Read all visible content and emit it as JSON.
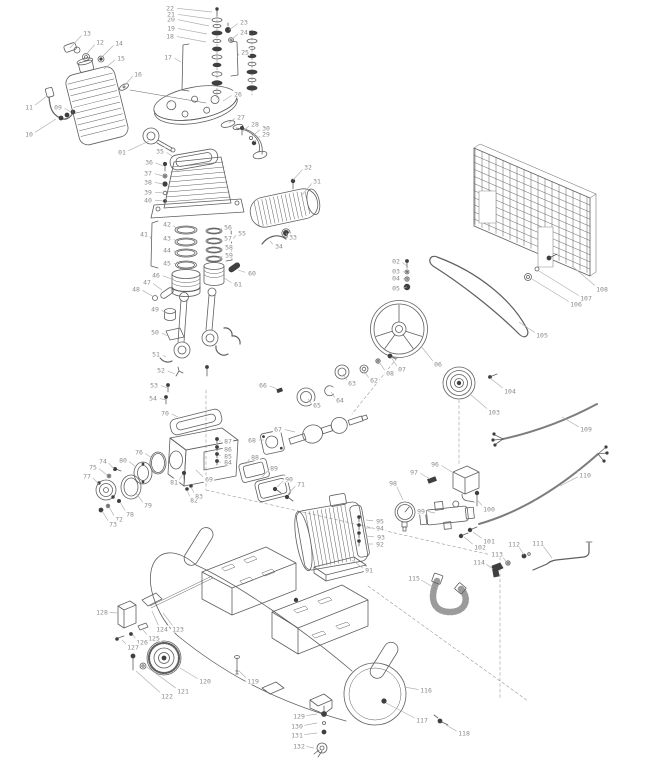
{
  "meta": {
    "canvas": {
      "width": 646,
      "height": 768
    }
  },
  "style": {
    "background": "#ffffff",
    "line_color": "#5f5f5f",
    "dark_hardware_color": "#3f3f3f",
    "label_color": "#8a8a8a",
    "leader_color": "#aeaeae"
  },
  "callouts": [
    {
      "n": "01",
      "x": 122,
      "y": 152,
      "tx": 149,
      "ty": 141
    },
    {
      "n": "02",
      "x": 396,
      "y": 261,
      "tx": 407,
      "ty": 266
    },
    {
      "n": "03",
      "x": 396,
      "y": 271,
      "tx": 407,
      "ty": 273
    },
    {
      "n": "04",
      "x": 396,
      "y": 278,
      "tx": 407,
      "ty": 280
    },
    {
      "n": "05",
      "x": 396,
      "y": 288,
      "tx": 407,
      "ty": 287
    },
    {
      "n": "06",
      "x": 438,
      "y": 364,
      "tx": 421,
      "ty": 346
    },
    {
      "n": "07",
      "x": 402,
      "y": 369,
      "tx": 391,
      "ty": 357
    },
    {
      "n": "08",
      "x": 390,
      "y": 373,
      "tx": 379,
      "ty": 362
    },
    {
      "n": "09",
      "x": 58,
      "y": 107,
      "tx": 71,
      "ty": 112
    },
    {
      "n": "10",
      "x": 29,
      "y": 134,
      "tx": 56,
      "ty": 119
    },
    {
      "n": "11",
      "x": 29,
      "y": 107,
      "tx": 47,
      "ty": 96
    },
    {
      "n": "12",
      "x": 100,
      "y": 42,
      "tx": 85,
      "ty": 56
    },
    {
      "n": "13",
      "x": 87,
      "y": 33,
      "tx": 70,
      "ty": 48
    },
    {
      "n": "14",
      "x": 119,
      "y": 43,
      "tx": 101,
      "ty": 58
    },
    {
      "n": "15",
      "x": 121,
      "y": 58,
      "tx": 104,
      "ty": 69
    },
    {
      "n": "16",
      "x": 138,
      "y": 74,
      "tx": 124,
      "ty": 86
    },
    {
      "n": "17",
      "x": 168,
      "y": 57,
      "tx": 181,
      "ty": 62
    },
    {
      "n": "18",
      "x": 170,
      "y": 36,
      "tx": 206,
      "ty": 42
    },
    {
      "n": "19",
      "x": 171,
      "y": 28,
      "tx": 207,
      "ty": 34
    },
    {
      "n": "20",
      "x": 171,
      "y": 19,
      "tx": 209,
      "ty": 26
    },
    {
      "n": "21",
      "x": 171,
      "y": 14,
      "tx": 211,
      "ty": 19
    },
    {
      "n": "22",
      "x": 170,
      "y": 8,
      "tx": 212,
      "ty": 12
    },
    {
      "n": "23",
      "x": 244,
      "y": 22,
      "tx": 229,
      "ty": 30
    },
    {
      "n": "24",
      "x": 244,
      "y": 32,
      "tx": 231,
      "ty": 40
    },
    {
      "n": "25",
      "x": 245,
      "y": 52,
      "tx": 237,
      "ty": 57
    },
    {
      "n": "26",
      "x": 238,
      "y": 94,
      "tx": 223,
      "ty": 101
    },
    {
      "n": "27",
      "x": 241,
      "y": 117,
      "tx": 229,
      "ty": 123
    },
    {
      "n": "28",
      "x": 255,
      "y": 124,
      "tx": 242,
      "ty": 132
    },
    {
      "n": "29",
      "x": 266,
      "y": 134,
      "tx": 254,
      "ty": 142
    },
    {
      "n": "30",
      "x": 266,
      "y": 128,
      "tx": 251,
      "ty": 137
    },
    {
      "n": "31",
      "x": 317,
      "y": 181,
      "tx": 301,
      "ty": 196
    },
    {
      "n": "32",
      "x": 308,
      "y": 167,
      "tx": 293,
      "ty": 180
    },
    {
      "n": "33",
      "x": 293,
      "y": 237,
      "tx": 286,
      "ty": 233
    },
    {
      "n": "34",
      "x": 279,
      "y": 246,
      "tx": 270,
      "ty": 241
    },
    {
      "n": "35",
      "x": 160,
      "y": 151,
      "tx": 172,
      "ty": 156
    },
    {
      "n": "36",
      "x": 149,
      "y": 162,
      "tx": 163,
      "ty": 166
    },
    {
      "n": "37",
      "x": 148,
      "y": 173,
      "tx": 163,
      "ty": 176
    },
    {
      "n": "38",
      "x": 148,
      "y": 182,
      "tx": 163,
      "ty": 184
    },
    {
      "n": "39",
      "x": 148,
      "y": 192,
      "tx": 163,
      "ty": 193
    },
    {
      "n": "40",
      "x": 148,
      "y": 200,
      "tx": 163,
      "ty": 201
    },
    {
      "n": "41",
      "x": 144,
      "y": 234,
      "tx": 151,
      "ty": 239
    },
    {
      "n": "42",
      "x": 167,
      "y": 224,
      "tx": 176,
      "ty": 228
    },
    {
      "n": "43",
      "x": 167,
      "y": 238,
      "tx": 176,
      "ty": 241
    },
    {
      "n": "44",
      "x": 167,
      "y": 250,
      "tx": 176,
      "ty": 252
    },
    {
      "n": "45",
      "x": 167,
      "y": 263,
      "tx": 176,
      "ty": 264
    },
    {
      "n": "46",
      "x": 156,
      "y": 275,
      "tx": 172,
      "ty": 279
    },
    {
      "n": "47",
      "x": 147,
      "y": 282,
      "tx": 162,
      "ty": 290
    },
    {
      "n": "48",
      "x": 136,
      "y": 289,
      "tx": 154,
      "ty": 297
    },
    {
      "n": "49",
      "x": 155,
      "y": 309,
      "tx": 166,
      "ty": 313
    },
    {
      "n": "50",
      "x": 155,
      "y": 332,
      "tx": 168,
      "ty": 336
    },
    {
      "n": "51",
      "x": 156,
      "y": 354,
      "tx": 166,
      "ty": 357
    },
    {
      "n": "52",
      "x": 161,
      "y": 370,
      "tx": 175,
      "ty": 374
    },
    {
      "n": "53",
      "x": 154,
      "y": 385,
      "tx": 168,
      "ty": 388
    },
    {
      "n": "54",
      "x": 153,
      "y": 398,
      "tx": 166,
      "ty": 400
    },
    {
      "n": "55",
      "x": 242,
      "y": 233,
      "tx": 233,
      "ty": 239
    },
    {
      "n": "56",
      "x": 228,
      "y": 227,
      "tx": 219,
      "ty": 231
    },
    {
      "n": "57",
      "x": 228,
      "y": 238,
      "tx": 219,
      "ty": 241
    },
    {
      "n": "58",
      "x": 229,
      "y": 247,
      "tx": 219,
      "ty": 250
    },
    {
      "n": "59",
      "x": 229,
      "y": 255,
      "tx": 219,
      "ty": 258
    },
    {
      "n": "60",
      "x": 252,
      "y": 273,
      "tx": 238,
      "ty": 270
    },
    {
      "n": "61",
      "x": 238,
      "y": 284,
      "tx": 224,
      "ty": 278
    },
    {
      "n": "62",
      "x": 374,
      "y": 380,
      "tx": 364,
      "ty": 371
    },
    {
      "n": "63",
      "x": 352,
      "y": 383,
      "tx": 343,
      "ty": 374
    },
    {
      "n": "64",
      "x": 340,
      "y": 400,
      "tx": 331,
      "ty": 392
    },
    {
      "n": "65",
      "x": 317,
      "y": 405,
      "tx": 308,
      "ty": 399
    },
    {
      "n": "66",
      "x": 263,
      "y": 385,
      "tx": 277,
      "ty": 389
    },
    {
      "n": "67",
      "x": 278,
      "y": 429,
      "tx": 295,
      "ty": 432
    },
    {
      "n": "68",
      "x": 252,
      "y": 440,
      "tx": 264,
      "ty": 440
    },
    {
      "n": "69",
      "x": 209,
      "y": 479,
      "tx": 196,
      "ty": 470
    },
    {
      "n": "70",
      "x": 165,
      "y": 413,
      "tx": 178,
      "ty": 417
    },
    {
      "n": "71",
      "x": 301,
      "y": 484,
      "tx": 288,
      "ty": 494
    },
    {
      "n": "72",
      "x": 119,
      "y": 519,
      "tx": 109,
      "ty": 507
    },
    {
      "n": "73",
      "x": 113,
      "y": 524,
      "tx": 102,
      "ty": 511
    },
    {
      "n": "74",
      "x": 103,
      "y": 461,
      "tx": 114,
      "ty": 469
    },
    {
      "n": "75",
      "x": 93,
      "y": 467,
      "tx": 107,
      "ty": 475
    },
    {
      "n": "76",
      "x": 139,
      "y": 452,
      "tx": 152,
      "ty": 458
    },
    {
      "n": "77",
      "x": 87,
      "y": 476,
      "tx": 99,
      "ty": 484
    },
    {
      "n": "78",
      "x": 130,
      "y": 514,
      "tx": 120,
      "ty": 502
    },
    {
      "n": "79",
      "x": 148,
      "y": 505,
      "tx": 136,
      "ty": 493
    },
    {
      "n": "80",
      "x": 123,
      "y": 460,
      "tx": 136,
      "ty": 467
    },
    {
      "n": "81",
      "x": 174,
      "y": 482,
      "tx": 183,
      "ty": 474
    },
    {
      "n": "82",
      "x": 194,
      "y": 500,
      "tx": 187,
      "ty": 490
    },
    {
      "n": "83",
      "x": 199,
      "y": 496,
      "tx": 191,
      "ty": 487
    },
    {
      "n": "84",
      "x": 228,
      "y": 462,
      "tx": 219,
      "ty": 462
    },
    {
      "n": "85",
      "x": 228,
      "y": 456,
      "tx": 219,
      "ty": 455
    },
    {
      "n": "86",
      "x": 228,
      "y": 449,
      "tx": 219,
      "ty": 448
    },
    {
      "n": "87",
      "x": 228,
      "y": 441,
      "tx": 219,
      "ty": 441
    },
    {
      "n": "88",
      "x": 255,
      "y": 457,
      "tx": 246,
      "ty": 464
    },
    {
      "n": "89",
      "x": 274,
      "y": 468,
      "tx": 262,
      "ty": 477
    },
    {
      "n": "90",
      "x": 289,
      "y": 479,
      "tx": 277,
      "ty": 487
    },
    {
      "n": "91",
      "x": 369,
      "y": 570,
      "tx": 352,
      "ty": 560
    },
    {
      "n": "92",
      "x": 380,
      "y": 544,
      "tx": 366,
      "ty": 544
    },
    {
      "n": "93",
      "x": 381,
      "y": 537,
      "tx": 366,
      "ty": 536
    },
    {
      "n": "94",
      "x": 380,
      "y": 528,
      "tx": 366,
      "ty": 528
    },
    {
      "n": "95",
      "x": 380,
      "y": 521,
      "tx": 366,
      "ty": 520
    },
    {
      "n": "96",
      "x": 435,
      "y": 464,
      "tx": 452,
      "ty": 472
    },
    {
      "n": "97",
      "x": 414,
      "y": 472,
      "tx": 430,
      "ty": 479
    },
    {
      "n": "98",
      "x": 393,
      "y": 483,
      "tx": 403,
      "ty": 500
    },
    {
      "n": "99",
      "x": 421,
      "y": 511,
      "tx": 435,
      "ty": 513
    },
    {
      "n": "100",
      "x": 489,
      "y": 509,
      "tx": 478,
      "ty": 501
    },
    {
      "n": "101",
      "x": 489,
      "y": 541,
      "tx": 473,
      "ty": 532
    },
    {
      "n": "102",
      "x": 480,
      "y": 547,
      "tx": 464,
      "ty": 537
    },
    {
      "n": "103",
      "x": 494,
      "y": 412,
      "tx": 470,
      "ty": 394
    },
    {
      "n": "104",
      "x": 510,
      "y": 391,
      "tx": 490,
      "ty": 378
    },
    {
      "n": "105",
      "x": 542,
      "y": 335,
      "tx": 519,
      "ty": 322
    },
    {
      "n": "106",
      "x": 576,
      "y": 304,
      "tx": 532,
      "ty": 279
    },
    {
      "n": "107",
      "x": 586,
      "y": 298,
      "tx": 539,
      "ty": 271
    },
    {
      "n": "108",
      "x": 602,
      "y": 289,
      "tx": 572,
      "ty": 266
    },
    {
      "n": "109",
      "x": 586,
      "y": 429,
      "tx": 562,
      "ty": 417
    },
    {
      "n": "110",
      "x": 585,
      "y": 475,
      "tx": 560,
      "ty": 486
    },
    {
      "n": "111",
      "x": 538,
      "y": 543,
      "tx": 552,
      "ty": 558
    },
    {
      "n": "112",
      "x": 514,
      "y": 544,
      "tx": 524,
      "ty": 555
    },
    {
      "n": "113",
      "x": 497,
      "y": 554,
      "tx": 507,
      "ty": 563
    },
    {
      "n": "114",
      "x": 479,
      "y": 562,
      "tx": 493,
      "ty": 569
    },
    {
      "n": "115",
      "x": 414,
      "y": 578,
      "tx": 433,
      "ty": 587
    },
    {
      "n": "116",
      "x": 426,
      "y": 690,
      "tx": 404,
      "ty": 687
    },
    {
      "n": "117",
      "x": 422,
      "y": 720,
      "tx": 386,
      "ty": 703
    },
    {
      "n": "118",
      "x": 464,
      "y": 733,
      "tx": 446,
      "ty": 725
    },
    {
      "n": "119",
      "x": 253,
      "y": 681,
      "tx": 239,
      "ty": 671
    },
    {
      "n": "120",
      "x": 205,
      "y": 681,
      "tx": 180,
      "ty": 668
    },
    {
      "n": "121",
      "x": 183,
      "y": 691,
      "tx": 147,
      "ty": 667
    },
    {
      "n": "122",
      "x": 167,
      "y": 696,
      "tx": 136,
      "ty": 671
    },
    {
      "n": "123",
      "x": 178,
      "y": 629,
      "tx": 163,
      "ty": 613
    },
    {
      "n": "124",
      "x": 162,
      "y": 629,
      "tx": 152,
      "ty": 611
    },
    {
      "n": "125",
      "x": 154,
      "y": 638,
      "tx": 143,
      "ty": 630
    },
    {
      "n": "126",
      "x": 142,
      "y": 642,
      "tx": 133,
      "ty": 635
    },
    {
      "n": "127",
      "x": 133,
      "y": 647,
      "tx": 122,
      "ty": 640
    },
    {
      "n": "128",
      "x": 102,
      "y": 612,
      "tx": 117,
      "ty": 613
    },
    {
      "n": "129",
      "x": 299,
      "y": 716,
      "tx": 317,
      "ty": 714
    },
    {
      "n": "130",
      "x": 297,
      "y": 726,
      "tx": 317,
      "ty": 723
    },
    {
      "n": "131",
      "x": 297,
      "y": 735,
      "tx": 317,
      "ty": 733
    },
    {
      "n": "132",
      "x": 299,
      "y": 746,
      "tx": 314,
      "ty": 748
    }
  ]
}
